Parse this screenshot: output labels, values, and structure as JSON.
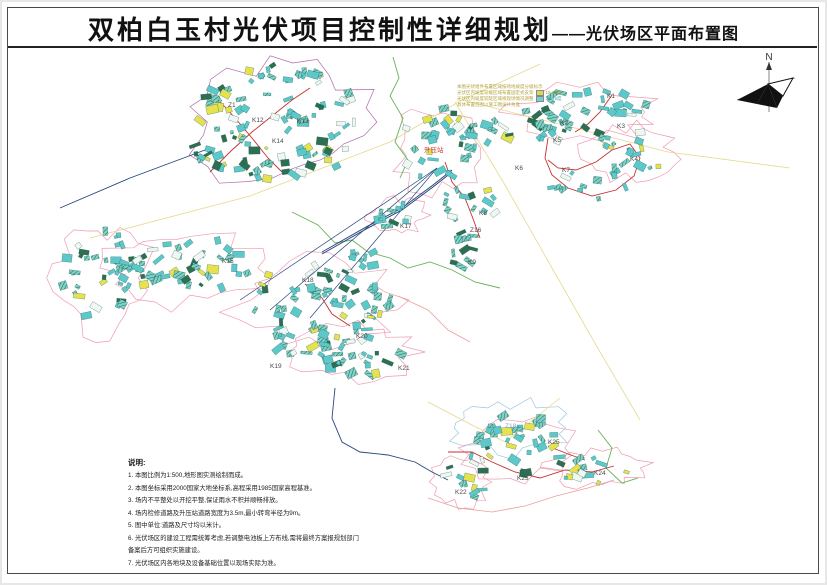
{
  "page": {
    "title_main": "双柏白玉村光伏项目控制性详细规划",
    "title_sub": "——光伏场区平面布置图"
  },
  "north": {
    "label": "N"
  },
  "legend": {
    "lines": [
      "本图光伏组件布置区域按场地坡度分级标示",
      "光伏区内坡度较缓区域布置固定式支架",
      "光伏区内坡度较陡区域视现场情况调整",
      "具体布置范围以施工图设计为准"
    ],
    "items": [
      {
        "label": "15-20度",
        "color": "#d8d94e"
      },
      {
        "label": "20-25度",
        "color": "#6fd3d3"
      }
    ]
  },
  "notes": {
    "heading": "说明:",
    "items": [
      "1. 本图比例为1:500,地形图实测绘制而成。",
      "2. 本图坐标采用2000国家大地坐标系,高程采用1985国家高程基准。",
      "3. 场内不平整处以开挖平整,保证雨水不积并顺畅排放。",
      "4. 场内检修道路及升压站道路宽度为3.5m,最小转弯半径为9m。",
      "5. 图中单位:道路及尺寸均以米计。",
      "6. 光伏场区的建设工程需统筹考虑,若调整电池板上方布线,需将最终方案报规划部门\n    备案后方可组织实施建设。",
      "7. 光伏场区内各地块及设备基础位置以现场实际为准。"
    ]
  },
  "map": {
    "colors": {
      "pv_cyan": "#5cc8ca",
      "pv_dark": "#2e6e52",
      "pv_yellow": "#e6e14f",
      "outline_pink": "#ef9bb0",
      "outline_purple": "#b06ab0",
      "outline_blue": "#9ec6e0",
      "road_red": "#c53030",
      "road_salmon": "#ec9f9f",
      "line_navy": "#26477f",
      "line_yellow": "#e6d98a",
      "stream_green": "#67b257",
      "label_gray": "#4a4a4a",
      "station_red": "#d03a2a"
    },
    "clusters": [
      {
        "cx": 282,
        "cy": 122,
        "rx": 85,
        "ry": 58,
        "n": 88
      },
      {
        "cx": 225,
        "cy": 150,
        "rx": 35,
        "ry": 22,
        "n": 18
      },
      {
        "cx": 183,
        "cy": 268,
        "rx": 72,
        "ry": 32,
        "n": 50
      },
      {
        "cx": 103,
        "cy": 278,
        "rx": 42,
        "ry": 48,
        "n": 30
      },
      {
        "cx": 318,
        "cy": 300,
        "rx": 75,
        "ry": 35,
        "n": 52
      },
      {
        "cx": 350,
        "cy": 352,
        "rx": 55,
        "ry": 25,
        "n": 30
      },
      {
        "cx": 300,
        "cy": 335,
        "rx": 35,
        "ry": 20,
        "n": 18
      },
      {
        "cx": 438,
        "cy": 148,
        "rx": 40,
        "ry": 40,
        "n": 34
      },
      {
        "cx": 488,
        "cy": 125,
        "rx": 28,
        "ry": 18,
        "n": 12
      },
      {
        "cx": 470,
        "cy": 205,
        "rx": 28,
        "ry": 20,
        "n": 14
      },
      {
        "cx": 463,
        "cy": 247,
        "rx": 15,
        "ry": 22,
        "n": 11,
        "dark": true
      },
      {
        "cx": 588,
        "cy": 112,
        "rx": 68,
        "ry": 22,
        "n": 32
      },
      {
        "cx": 630,
        "cy": 152,
        "rx": 40,
        "ry": 22,
        "n": 18
      },
      {
        "cx": 586,
        "cy": 186,
        "rx": 45,
        "ry": 15,
        "n": 12
      },
      {
        "cx": 545,
        "cy": 132,
        "rx": 20,
        "ry": 12,
        "n": 8
      },
      {
        "cx": 517,
        "cy": 448,
        "rx": 50,
        "ry": 28,
        "n": 26
      },
      {
        "cx": 597,
        "cy": 468,
        "rx": 42,
        "ry": 15,
        "n": 14
      },
      {
        "cx": 462,
        "cy": 482,
        "rx": 25,
        "ry": 22,
        "n": 12
      },
      {
        "cx": 398,
        "cy": 215,
        "rx": 25,
        "ry": 14,
        "n": 10
      },
      {
        "cx": 365,
        "cy": 258,
        "rx": 20,
        "ry": 12,
        "n": 8
      },
      {
        "cx": 530,
        "cy": 425,
        "rx": 35,
        "ry": 15,
        "n": 10
      }
    ],
    "outlines": [
      {
        "cx": 282,
        "cy": 122,
        "rx": 92,
        "ry": 62,
        "color": "#b06ab0"
      },
      {
        "cx": 183,
        "cy": 268,
        "rx": 78,
        "ry": 36,
        "color": "#ef9bb0"
      },
      {
        "cx": 103,
        "cy": 278,
        "rx": 46,
        "ry": 52,
        "color": "#ef9bb0"
      },
      {
        "cx": 318,
        "cy": 300,
        "rx": 80,
        "ry": 40,
        "color": "#ef9bb0"
      },
      {
        "cx": 350,
        "cy": 352,
        "rx": 60,
        "ry": 28,
        "color": "#ef9bb0"
      },
      {
        "cx": 438,
        "cy": 148,
        "rx": 45,
        "ry": 45,
        "color": "#ef9bb0"
      },
      {
        "cx": 588,
        "cy": 112,
        "rx": 72,
        "ry": 26,
        "color": "#ef9bb0"
      },
      {
        "cx": 630,
        "cy": 152,
        "rx": 44,
        "ry": 26,
        "color": "#ef9bb0"
      },
      {
        "cx": 517,
        "cy": 448,
        "rx": 54,
        "ry": 30,
        "color": "#ef9bb0"
      },
      {
        "cx": 597,
        "cy": 468,
        "rx": 46,
        "ry": 18,
        "color": "#ef9bb0"
      },
      {
        "cx": 462,
        "cy": 482,
        "rx": 28,
        "ry": 25,
        "color": "#ef9bb0"
      },
      {
        "cx": 505,
        "cy": 428,
        "rx": 58,
        "ry": 26,
        "color": "#9ec6e0"
      },
      {
        "cx": 398,
        "cy": 215,
        "rx": 28,
        "ry": 16,
        "color": "#ef9bb0"
      }
    ],
    "lines": [
      {
        "color": "#e6d98a",
        "w": 0.8,
        "points": [
          [
            90,
            238
          ],
          [
            250,
            196
          ],
          [
            390,
            142
          ],
          [
            462,
            100
          ],
          [
            540,
            64
          ]
        ]
      },
      {
        "color": "#e6d98a",
        "w": 0.8,
        "points": [
          [
            462,
            100
          ],
          [
            575,
            128
          ],
          [
            668,
            152
          ],
          [
            790,
            168
          ]
        ]
      },
      {
        "color": "#e6d98a",
        "w": 0.8,
        "points": [
          [
            455,
            102
          ],
          [
            505,
            185
          ],
          [
            552,
            268
          ],
          [
            600,
            352
          ],
          [
            640,
            420
          ]
        ]
      },
      {
        "color": "#e6d98a",
        "w": 0.8,
        "points": [
          [
            428,
            402
          ],
          [
            470,
            424
          ],
          [
            505,
            442
          ]
        ]
      },
      {
        "color": "#e6d98a",
        "w": 0.8,
        "points": [
          [
            560,
            398
          ],
          [
            530,
            422
          ],
          [
            505,
            442
          ]
        ]
      },
      {
        "color": "#67b257",
        "w": 0.9,
        "points": [
          [
            393,
            57
          ],
          [
            399,
            78
          ],
          [
            390,
            96
          ],
          [
            403,
            118
          ],
          [
            395,
            142
          ],
          [
            408,
            160
          ],
          [
            400,
            178
          ]
        ]
      },
      {
        "color": "#67b257",
        "w": 0.9,
        "points": [
          [
            292,
            212
          ],
          [
            318,
            225
          ],
          [
            335,
            243
          ],
          [
            352,
            240
          ],
          [
            368,
            252
          ],
          [
            390,
            258
          ],
          [
            408,
            268
          ],
          [
            430,
            262
          ],
          [
            452,
            270
          ],
          [
            475,
            282
          ],
          [
            500,
            288
          ]
        ]
      },
      {
        "color": "#67b257",
        "w": 0.9,
        "points": [
          [
            598,
            430
          ],
          [
            612,
            448
          ],
          [
            606,
            468
          ],
          [
            622,
            483
          ],
          [
            638,
            478
          ]
        ]
      },
      {
        "color": "#26477f",
        "w": 1,
        "double": true,
        "points": [
          [
            322,
            252
          ],
          [
            368,
            226
          ],
          [
            402,
            208
          ],
          [
            433,
            185
          ],
          [
            452,
            170
          ]
        ]
      },
      {
        "color": "#26477f",
        "w": 0.7,
        "points": [
          [
            437,
            168
          ],
          [
            240,
            300
          ]
        ]
      },
      {
        "color": "#26477f",
        "w": 0.7,
        "points": [
          [
            437,
            168
          ],
          [
            270,
            310
          ]
        ]
      },
      {
        "color": "#26477f",
        "w": 0.7,
        "points": [
          [
            437,
            168
          ],
          [
            310,
            318
          ]
        ]
      },
      {
        "color": "#26477f",
        "w": 0.9,
        "points": [
          [
            335,
            388
          ],
          [
            332,
            418
          ],
          [
            342,
            442
          ],
          [
            360,
            452
          ],
          [
            388,
            455
          ],
          [
            415,
            462
          ],
          [
            432,
            472
          ],
          [
            448,
            480
          ]
        ]
      },
      {
        "color": "#26477f",
        "w": 0.9,
        "points": [
          [
            60,
            208
          ],
          [
            130,
            178
          ],
          [
            205,
            150
          ]
        ]
      },
      {
        "color": "#c53030",
        "w": 0.9,
        "points": [
          [
            210,
            172
          ],
          [
            232,
            150
          ],
          [
            252,
            132
          ],
          [
            272,
            116
          ],
          [
            292,
            100
          ],
          [
            310,
            88
          ]
        ]
      },
      {
        "color": "#c53030",
        "w": 0.9,
        "points": [
          [
            215,
            96
          ],
          [
            235,
            118
          ],
          [
            252,
            138
          ],
          [
            268,
            158
          ],
          [
            282,
            172
          ]
        ]
      },
      {
        "color": "#c53030",
        "w": 0.9,
        "points": [
          [
            445,
            162
          ],
          [
            452,
            182
          ],
          [
            465,
            198
          ],
          [
            472,
            216
          ],
          [
            480,
            238
          ]
        ]
      },
      {
        "color": "#c53030",
        "w": 0.9,
        "points": [
          [
            548,
            138
          ],
          [
            545,
            158
          ],
          [
            552,
            175
          ],
          [
            568,
            188
          ],
          [
            592,
            196
          ],
          [
            616,
            190
          ],
          [
            634,
            176
          ],
          [
            640,
            158
          ],
          [
            630,
            144
          ],
          [
            612,
            150
          ],
          [
            596,
            162
          ],
          [
            576,
            170
          ],
          [
            558,
            168
          ],
          [
            548,
            160
          ]
        ]
      },
      {
        "color": "#c53030",
        "w": 0.9,
        "points": [
          [
            612,
            95
          ],
          [
            600,
            112
          ],
          [
            588,
            124
          ],
          [
            575,
            132
          ]
        ]
      },
      {
        "color": "#c53030",
        "w": 0.9,
        "points": [
          [
            305,
            284
          ],
          [
            322,
            298
          ],
          [
            332,
            314
          ],
          [
            350,
            326
          ]
        ]
      },
      {
        "color": "#c53030",
        "w": 0.9,
        "points": [
          [
            448,
            452
          ],
          [
            472,
            452
          ],
          [
            492,
            462
          ],
          [
            515,
            472
          ],
          [
            540,
            478
          ],
          [
            565,
            470
          ],
          [
            592,
            472
          ],
          [
            614,
            466
          ]
        ]
      },
      {
        "color": "#c53030",
        "w": 0.9,
        "points": [
          [
            548,
            446
          ],
          [
            568,
            454
          ],
          [
            585,
            460
          ]
        ]
      },
      {
        "color": "#ec9f9f",
        "w": 0.8,
        "points": [
          [
            428,
            498
          ],
          [
            458,
            508
          ],
          [
            492,
            512
          ],
          [
            525,
            506
          ],
          [
            556,
            496
          ],
          [
            588,
            488
          ],
          [
            614,
            480
          ]
        ]
      },
      {
        "color": "#ec9f9f",
        "w": 0.8,
        "points": [
          [
            398,
            296
          ],
          [
            428,
            310
          ],
          [
            448,
            330
          ],
          [
            470,
            342
          ]
        ]
      }
    ],
    "labels": [
      {
        "t": "Z1",
        "x": 228,
        "y": 107
      },
      {
        "t": "K12",
        "x": 252,
        "y": 122
      },
      {
        "t": "K13",
        "x": 297,
        "y": 123
      },
      {
        "t": "K14",
        "x": 272,
        "y": 143
      },
      {
        "t": "K1",
        "x": 607,
        "y": 98
      },
      {
        "t": "K2",
        "x": 560,
        "y": 125
      },
      {
        "t": "K3",
        "x": 617,
        "y": 128
      },
      {
        "t": "K4",
        "x": 630,
        "y": 161
      },
      {
        "t": "K5",
        "x": 553,
        "y": 142
      },
      {
        "t": "K6",
        "x": 515,
        "y": 170
      },
      {
        "t": "K7",
        "x": 562,
        "y": 172
      },
      {
        "t": "升压站",
        "x": 424,
        "y": 152,
        "c": "#d03a2a"
      },
      {
        "t": "K8",
        "x": 479,
        "y": 215
      },
      {
        "t": "Z16",
        "x": 470,
        "y": 232
      },
      {
        "t": "K9",
        "x": 468,
        "y": 264
      },
      {
        "t": "K17",
        "x": 400,
        "y": 228
      },
      {
        "t": "K15",
        "x": 222,
        "y": 263
      },
      {
        "t": "K18",
        "x": 302,
        "y": 282
      },
      {
        "t": "K19",
        "x": 270,
        "y": 368
      },
      {
        "t": "K20",
        "x": 356,
        "y": 338
      },
      {
        "t": "K21",
        "x": 398,
        "y": 370
      },
      {
        "t": "Z18",
        "x": 505,
        "y": 428,
        "c": "#8aa8c0"
      },
      {
        "t": "K25",
        "x": 548,
        "y": 444
      },
      {
        "t": "K22",
        "x": 455,
        "y": 494
      },
      {
        "t": "K23",
        "x": 517,
        "y": 480
      },
      {
        "t": "K24",
        "x": 594,
        "y": 475
      }
    ]
  }
}
